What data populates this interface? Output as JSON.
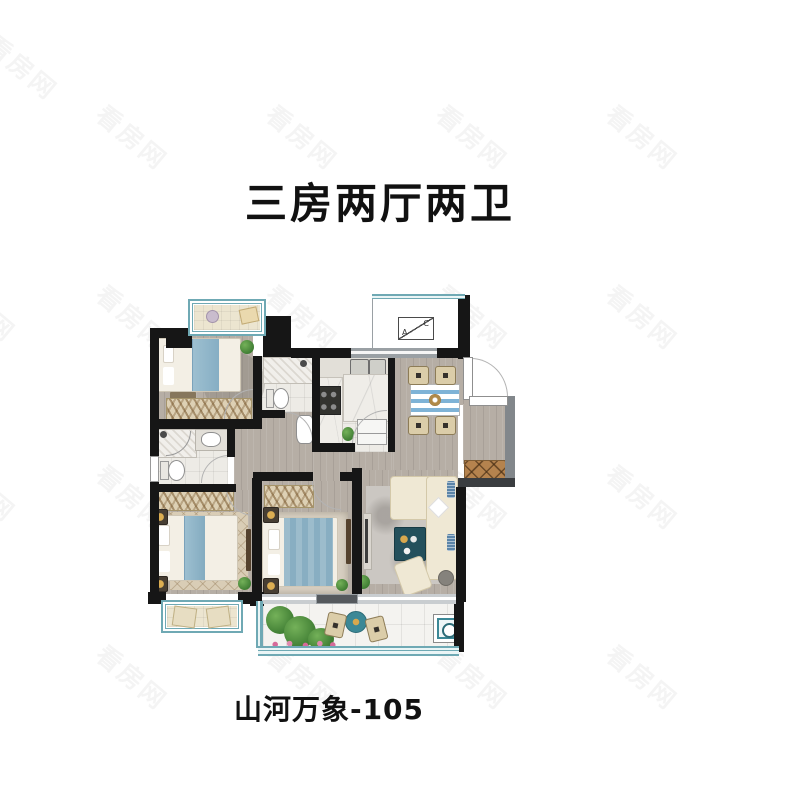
{
  "header": {
    "title": "三房两厅两卫"
  },
  "footer": {
    "caption": "山河万象-105"
  },
  "watermark": {
    "text": "看房网"
  },
  "floor_plan": {
    "ac_platform": {
      "left_letter": "A",
      "right_letter": "C"
    },
    "colors": {
      "wall": "#161616",
      "secondary_wall": "#82878b",
      "wood_floor": "#b6aea5",
      "tile_floor": "#edebe6",
      "balcony_tile": "#f4f3f0",
      "window_frame_teal": "#6fa9b4",
      "bed_blanket_blue": "#8fb6c9",
      "sofa_cream": "#efe8d4",
      "coffee_table_teal": "#24505c",
      "dining_table_stripe_blue": "#7fb3d6",
      "wardrobe_beige": "#ddd0b4",
      "shoe_cabinet_brown": "#b5834e",
      "plant_green": "#4f9140",
      "title_text": "#111111",
      "watermark_gray": "#e9e9e9"
    }
  }
}
